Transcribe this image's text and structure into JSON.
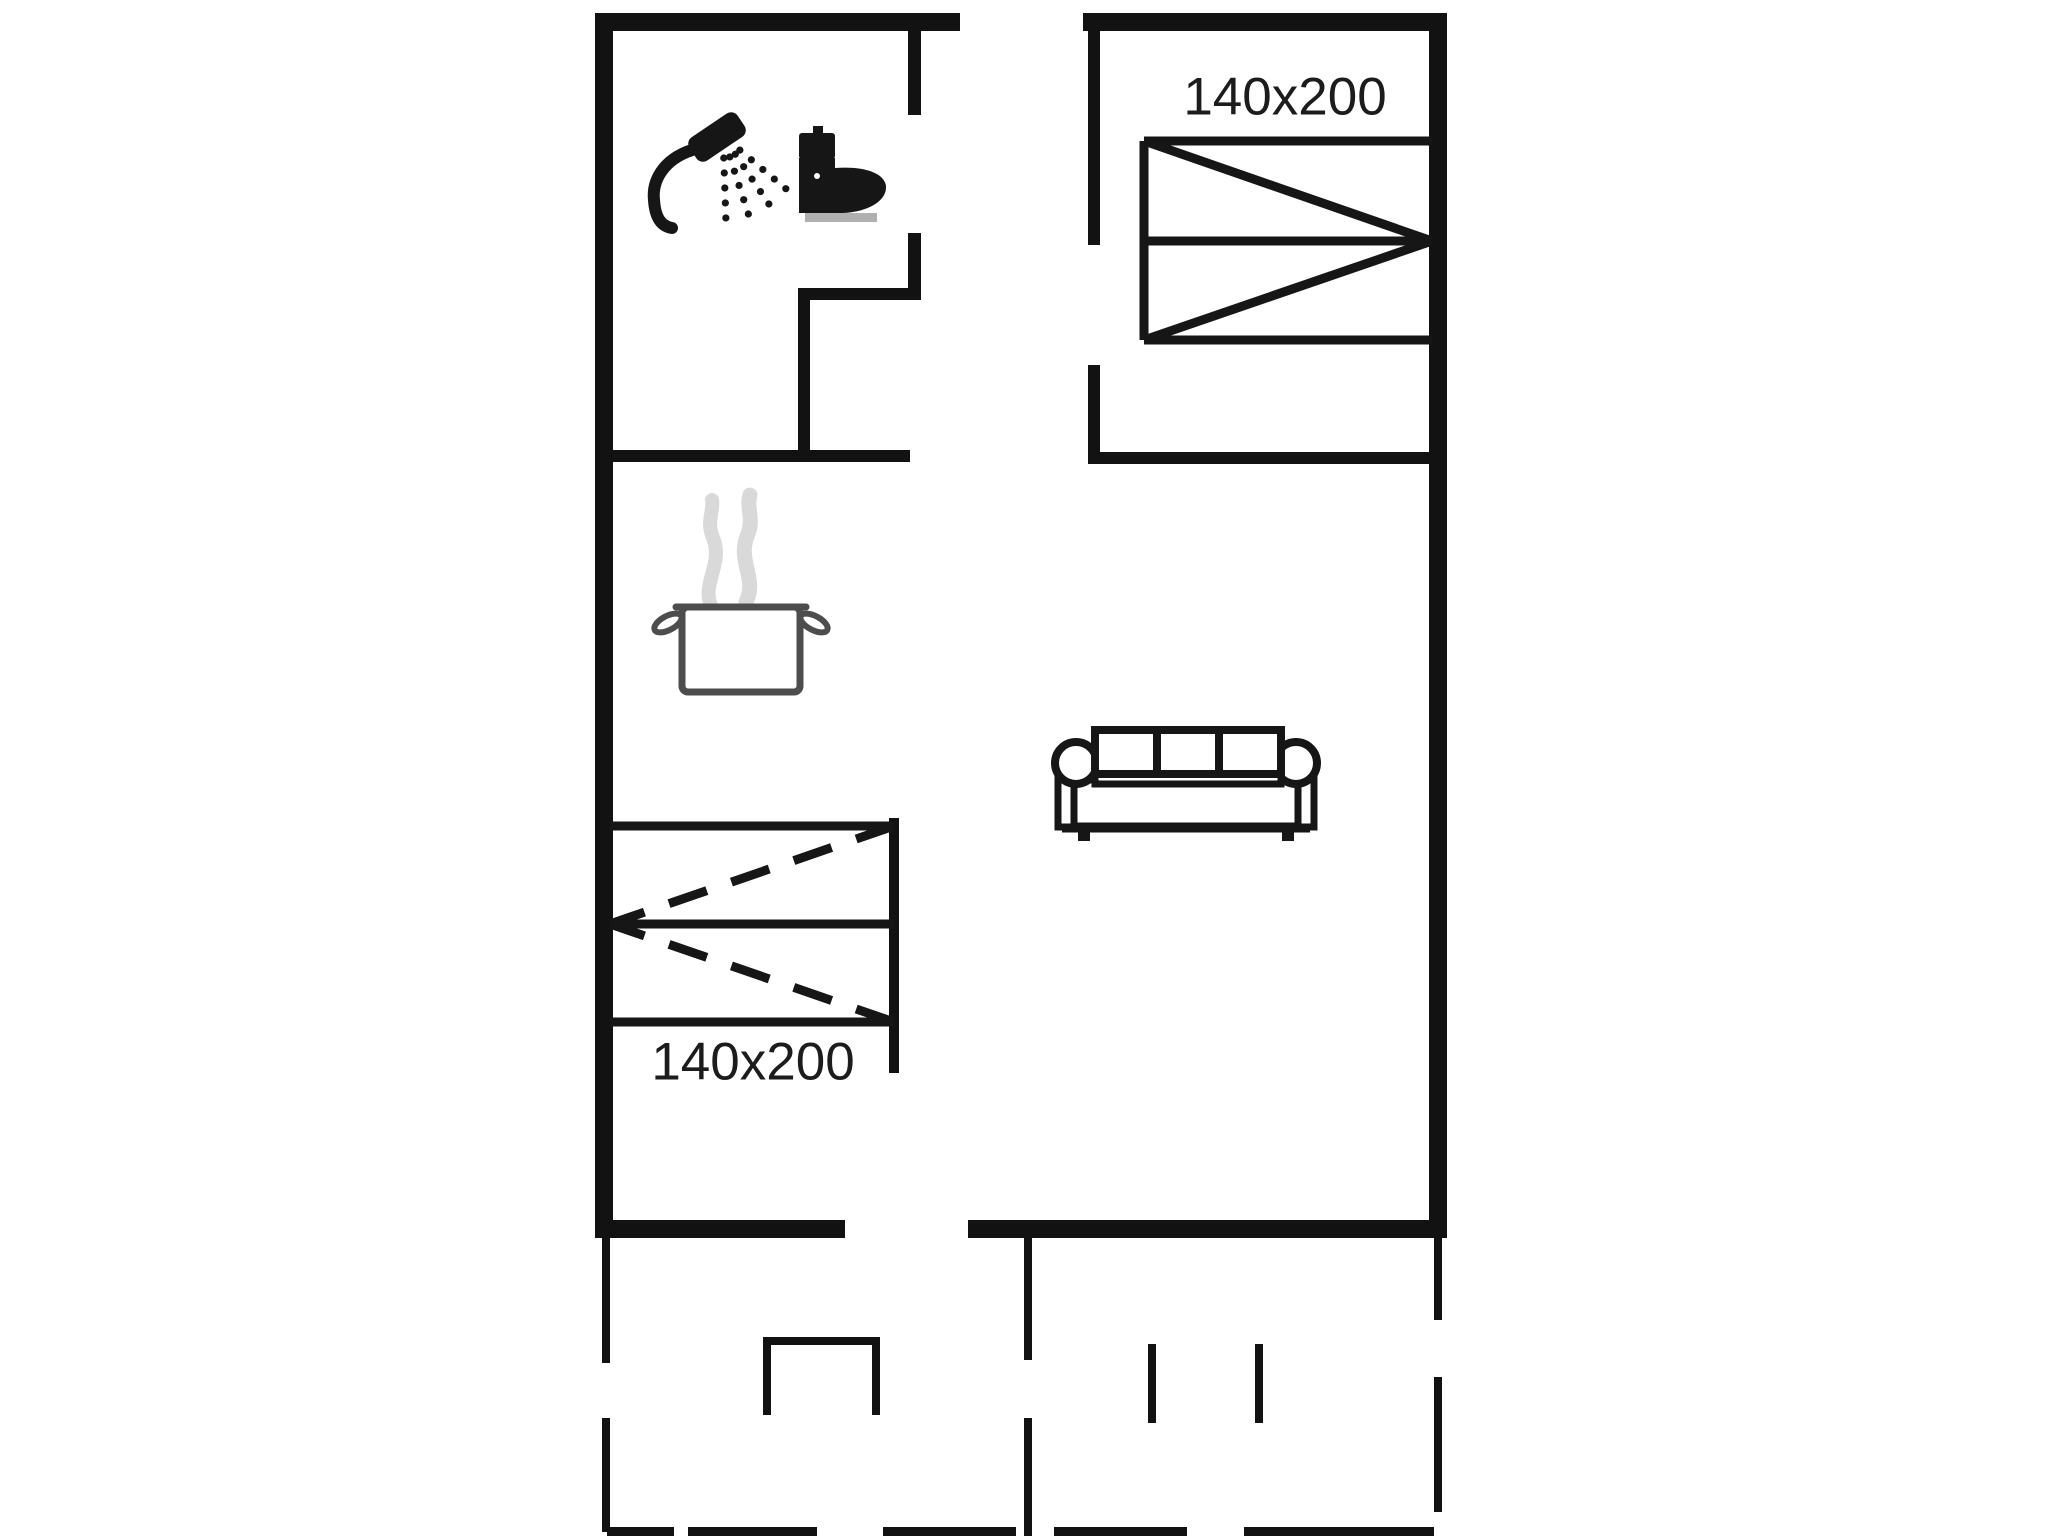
{
  "page": {
    "title": "Holiday home floor plan",
    "background": "#ffffff"
  },
  "plan": {
    "canvas": {
      "width": 2048,
      "height": 1536
    },
    "colors": {
      "wall": "#121212",
      "furniture": "#161616",
      "pot_outline": "#4d4d4d",
      "steam": "#d9d9d9",
      "toilet_base": "#b0b0b0",
      "label": "#1c1c1c"
    },
    "labels": [
      {
        "name": "bed-size-label-bedroom",
        "text": "140x200",
        "x": 1285,
        "y": 96,
        "font_size": 53
      },
      {
        "name": "bed-size-label-alcove",
        "text": "140x200",
        "x": 753,
        "y": 1061,
        "font_size": 53
      }
    ],
    "walls": [
      {
        "name": "outer-wall-top-left",
        "x": 595,
        "y": 13,
        "w": 365,
        "h": 18
      },
      {
        "name": "outer-wall-top-right",
        "x": 1083,
        "y": 13,
        "w": 364,
        "h": 18
      },
      {
        "name": "outer-wall-left",
        "x": 595,
        "y": 13,
        "w": 18,
        "h": 1225
      },
      {
        "name": "outer-wall-right",
        "x": 1429,
        "y": 13,
        "w": 18,
        "h": 1225
      },
      {
        "name": "living-room-wall-bottom-left",
        "x": 595,
        "y": 1220,
        "w": 250,
        "h": 18
      },
      {
        "name": "living-room-wall-bottom-right",
        "x": 968,
        "y": 1220,
        "w": 479,
        "h": 18
      },
      {
        "name": "bathroom-wall-right-upper",
        "x": 908,
        "y": 31,
        "w": 13,
        "h": 84
      },
      {
        "name": "bathroom-wall-right-lower",
        "x": 908,
        "y": 233,
        "w": 13,
        "h": 67
      },
      {
        "name": "bathroom-inner-wall-horizontal",
        "x": 798,
        "y": 288,
        "w": 123,
        "h": 12
      },
      {
        "name": "bathroom-inner-wall-vertical",
        "x": 798,
        "y": 300,
        "w": 12,
        "h": 152
      },
      {
        "name": "kitchen-divider-wall",
        "x": 600,
        "y": 450,
        "w": 310,
        "h": 12
      },
      {
        "name": "bedroom-wall-left-upper",
        "x": 1088,
        "y": 31,
        "w": 12,
        "h": 214
      },
      {
        "name": "bedroom-wall-left-lower",
        "x": 1088,
        "y": 365,
        "w": 12,
        "h": 87
      },
      {
        "name": "bedroom-wall-bottom",
        "x": 1088,
        "y": 452,
        "w": 359,
        "h": 12
      },
      {
        "name": "bed-alcove-partition",
        "x": 889,
        "y": 818,
        "w": 10,
        "h": 255
      },
      {
        "name": "terrace-fence-left-upper",
        "x": 602,
        "y": 1238,
        "w": 8,
        "h": 125
      },
      {
        "name": "terrace-fence-left-lower",
        "x": 602,
        "y": 1418,
        "w": 8,
        "h": 114
      },
      {
        "name": "terrace-divider-fence-upper",
        "x": 1024,
        "y": 1238,
        "w": 8,
        "h": 122
      },
      {
        "name": "terrace-divider-fence-lower",
        "x": 1024,
        "y": 1418,
        "w": 8,
        "h": 118
      },
      {
        "name": "terrace-fence-right-upper",
        "x": 1434,
        "y": 1238,
        "w": 8,
        "h": 82
      },
      {
        "name": "terrace-fence-right-lower",
        "x": 1434,
        "y": 1377,
        "w": 8,
        "h": 135
      },
      {
        "name": "terrace-post-left",
        "x": 1148,
        "y": 1344,
        "w": 8,
        "h": 79
      },
      {
        "name": "terrace-post-right",
        "x": 1255,
        "y": 1344,
        "w": 8,
        "h": 79
      },
      {
        "name": "entrance-step-left-leg",
        "x": 763,
        "y": 1337,
        "w": 8,
        "h": 78
      },
      {
        "name": "entrance-step-top-bar",
        "x": 763,
        "y": 1337,
        "w": 117,
        "h": 8
      },
      {
        "name": "entrance-step-right-leg",
        "x": 872,
        "y": 1337,
        "w": 8,
        "h": 78
      },
      {
        "name": "terrace-boundary-dash-1",
        "x": 607,
        "y": 1527,
        "w": 67,
        "h": 9
      },
      {
        "name": "terrace-boundary-dash-2",
        "x": 688,
        "y": 1527,
        "w": 129,
        "h": 9
      },
      {
        "name": "terrace-boundary-dash-3",
        "x": 883,
        "y": 1527,
        "w": 133,
        "h": 9
      },
      {
        "name": "terrace-boundary-dash-4",
        "x": 1054,
        "y": 1527,
        "w": 133,
        "h": 9
      },
      {
        "name": "terrace-boundary-dash-5",
        "x": 1244,
        "y": 1527,
        "w": 190,
        "h": 9
      }
    ],
    "beds": [
      {
        "name": "bedroom-double-bed",
        "size": "140x200",
        "x1": 1144,
        "y1": 141,
        "x2": 1432,
        "y2": 340,
        "mid_y": 241,
        "apex": "right",
        "dashed": false,
        "edge": "left",
        "stroke": 9
      },
      {
        "name": "alcove-double-bed",
        "size": "140x200",
        "x1": 610,
        "y1": 826,
        "x2": 894,
        "y2": 1022,
        "mid_y": 924,
        "apex": "left",
        "dashed": true,
        "edge": "none",
        "stroke": 9
      }
    ],
    "icons": [
      {
        "name": "shower-icon",
        "x": 650,
        "y": 112
      },
      {
        "name": "toilet-icon",
        "x": 796,
        "y": 124
      },
      {
        "name": "cooking-pot-icon",
        "x": 650,
        "y": 490
      },
      {
        "name": "sofa-icon",
        "x": 1054,
        "y": 724
      }
    ]
  }
}
